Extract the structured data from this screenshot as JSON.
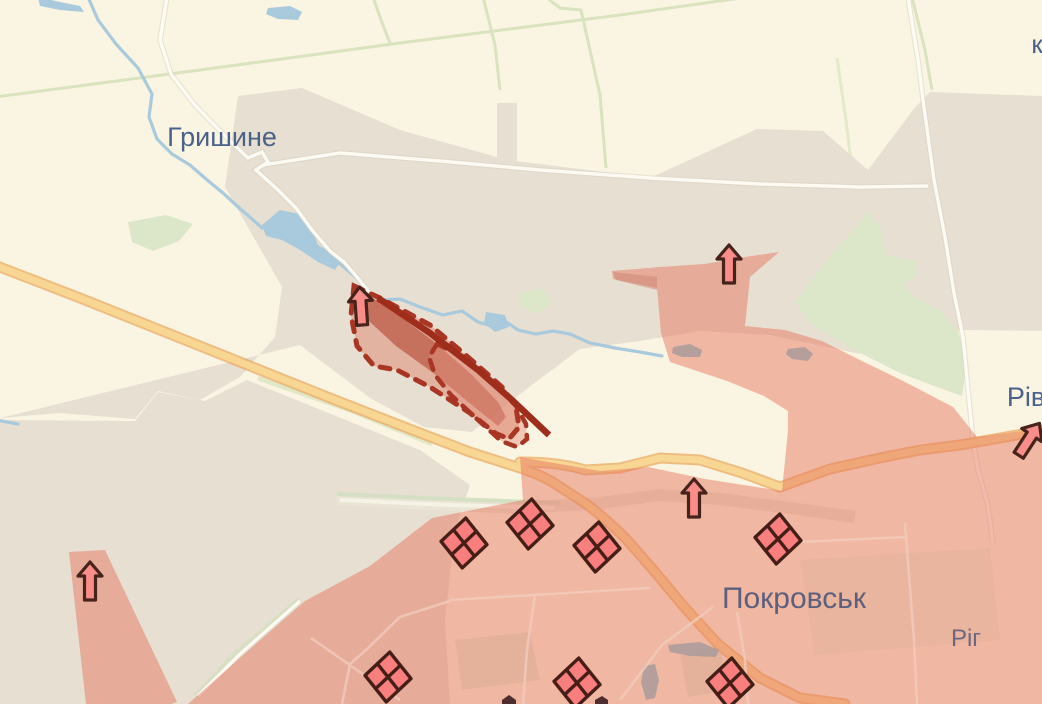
{
  "map_labels": [
    {
      "id": "hryshyne",
      "text": "Гришине",
      "x": 222,
      "y": 146,
      "size": 27,
      "color": "#4a618a"
    },
    {
      "id": "pokrovsk",
      "text": "Покровськ",
      "x": 794,
      "y": 608,
      "size": 30,
      "color": "#5d5f7d"
    },
    {
      "id": "riv",
      "text": "Рів",
      "x": 1026,
      "y": 406,
      "size": 27,
      "color": "#4a618a"
    },
    {
      "id": "rih",
      "text": "Ріг",
      "x": 966,
      "y": 646,
      "size": 24,
      "color": "#6e6680"
    },
    {
      "id": "k",
      "text": "к",
      "x": 1037,
      "y": 53,
      "size": 26,
      "color": "#4a618a"
    }
  ],
  "attack_arrows": {
    "symbol": "up-arrow",
    "fill": "#f98d8a",
    "outline": "#46241c",
    "items": [
      {
        "x": 361,
        "y": 308,
        "rotation": -4
      },
      {
        "x": 729,
        "y": 266,
        "rotation": 0
      },
      {
        "x": 694,
        "y": 500,
        "rotation": 0
      },
      {
        "x": 90,
        "y": 583,
        "rotation": 0
      },
      {
        "x": 1028,
        "y": 441,
        "rotation": 33
      }
    ]
  },
  "unit_markers": {
    "symbol": "quartered-diamond",
    "fill": "#f97f7f",
    "outline": "#451f17",
    "rotation": 4,
    "items": [
      {
        "x": 464,
        "y": 543
      },
      {
        "x": 530,
        "y": 524
      },
      {
        "x": 597,
        "y": 547
      },
      {
        "x": 778,
        "y": 539
      },
      {
        "x": 388,
        "y": 677
      },
      {
        "x": 577,
        "y": 683
      },
      {
        "x": 730,
        "y": 683
      }
    ]
  },
  "zones": {
    "occupied_fill": "#e5745c",
    "occupied_opacity": 0.48,
    "advance_dash_color": "#a93524",
    "advance_core_color": "#b24530",
    "advance_solid_line_color": "#9f2d1c"
  },
  "base_colors": {
    "background": "#faf5e2",
    "settlement_gray": "#e7dfd2",
    "forest_green": "#dce6c9",
    "water_blue": "#a9cadd",
    "highway_core": "#f8d795",
    "highway_casing": "#eaaa60",
    "road_white": "#fdfcf6"
  }
}
